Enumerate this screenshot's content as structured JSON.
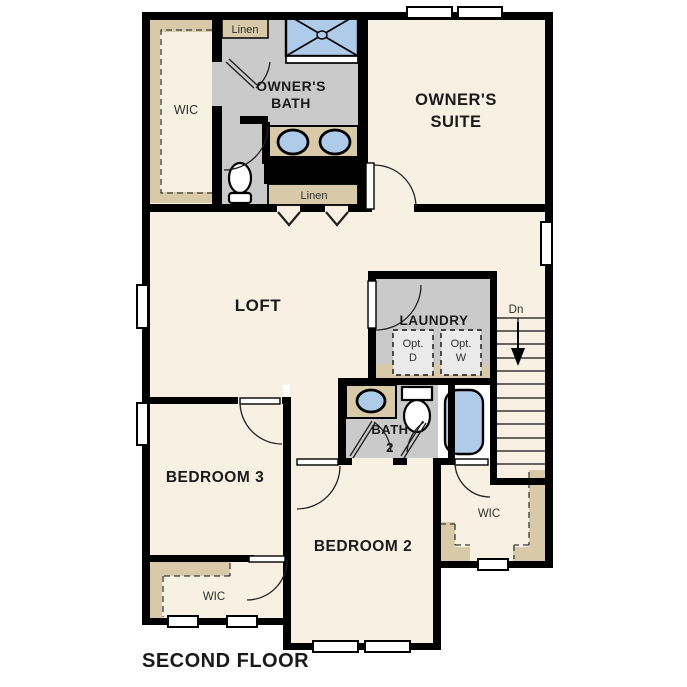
{
  "title": "SECOND FLOOR",
  "colors": {
    "floor": "#f8f0e2",
    "wall": "#000000",
    "bath_gray": "#cbcaca",
    "shelf_tan": "#d8c9a9",
    "fixture_blue": "#aecbe9",
    "opt_box": "#eaeaea",
    "label": "#1a1a1a"
  },
  "rooms": {
    "owners_suite": {
      "line1": "OWNER'S",
      "line2": "SUITE"
    },
    "owners_bath": {
      "line1": "OWNER'S",
      "line2": "BATH"
    },
    "loft": "LOFT",
    "laundry": "LAUNDRY",
    "bedroom3": "BEDROOM 3",
    "bedroom2": "BEDROOM 2",
    "bath2": {
      "line1": "BATH",
      "line2": "2"
    },
    "wic_owner": "WIC",
    "wic_bedroom3": "WIC",
    "wic_bedroom2": "WIC",
    "linen_top": "Linen",
    "linen_hall": "Linen",
    "stairs_direction": "Dn",
    "opt_dryer": {
      "line1": "Opt.",
      "line2": "D"
    },
    "opt_washer": {
      "line1": "Opt.",
      "line2": "W"
    }
  }
}
